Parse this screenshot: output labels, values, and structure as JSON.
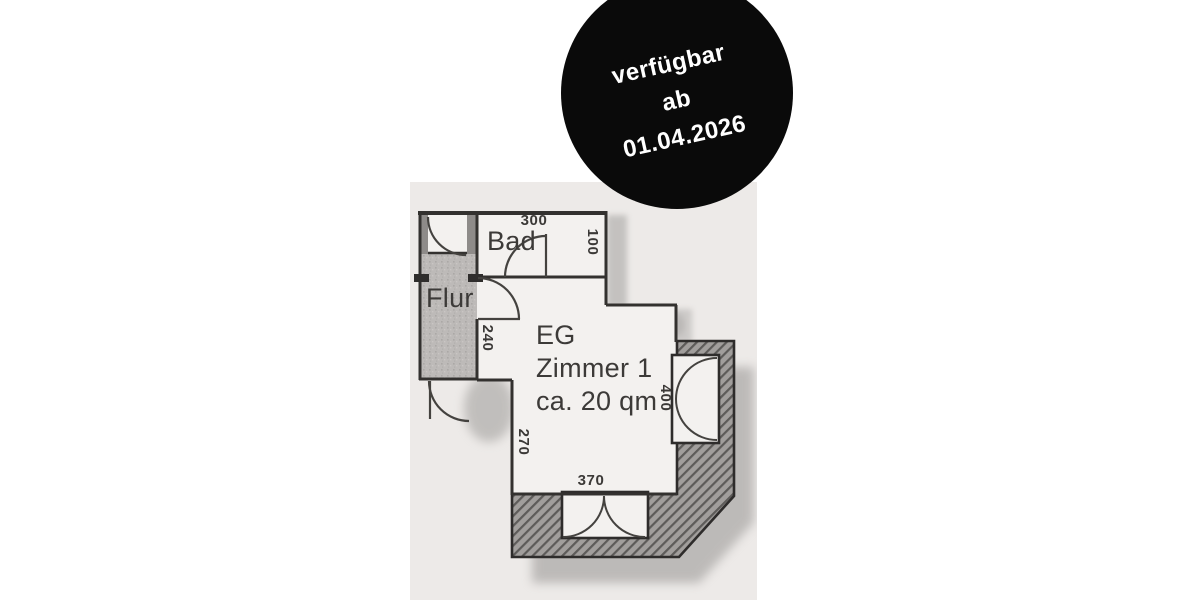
{
  "badge": {
    "line1": "verfügbar",
    "line2": "ab",
    "line3": "01.04.2026",
    "bg_color": "#0a0a0a",
    "text_color": "#ffffff"
  },
  "floorplan": {
    "rooms": {
      "bathroom_label": "Bad",
      "hallway_label": "Flur",
      "main_room_lines": [
        "EG",
        "Zimmer 1",
        "ca. 20 qm"
      ]
    },
    "dimensions": {
      "bath_width_top": "300",
      "bath_right": "100",
      "wall_left_upper": "240",
      "wall_left_lower": "270",
      "window_right": "400",
      "window_bottom": "370"
    },
    "colors": {
      "paper": "#edeae8",
      "room_fill": "#f3f1ef",
      "hallway_fill": "#bdbab8",
      "wall_line": "#33312f",
      "hatch_fill": "#a19e9c",
      "label_text": "#3c3a38"
    }
  }
}
